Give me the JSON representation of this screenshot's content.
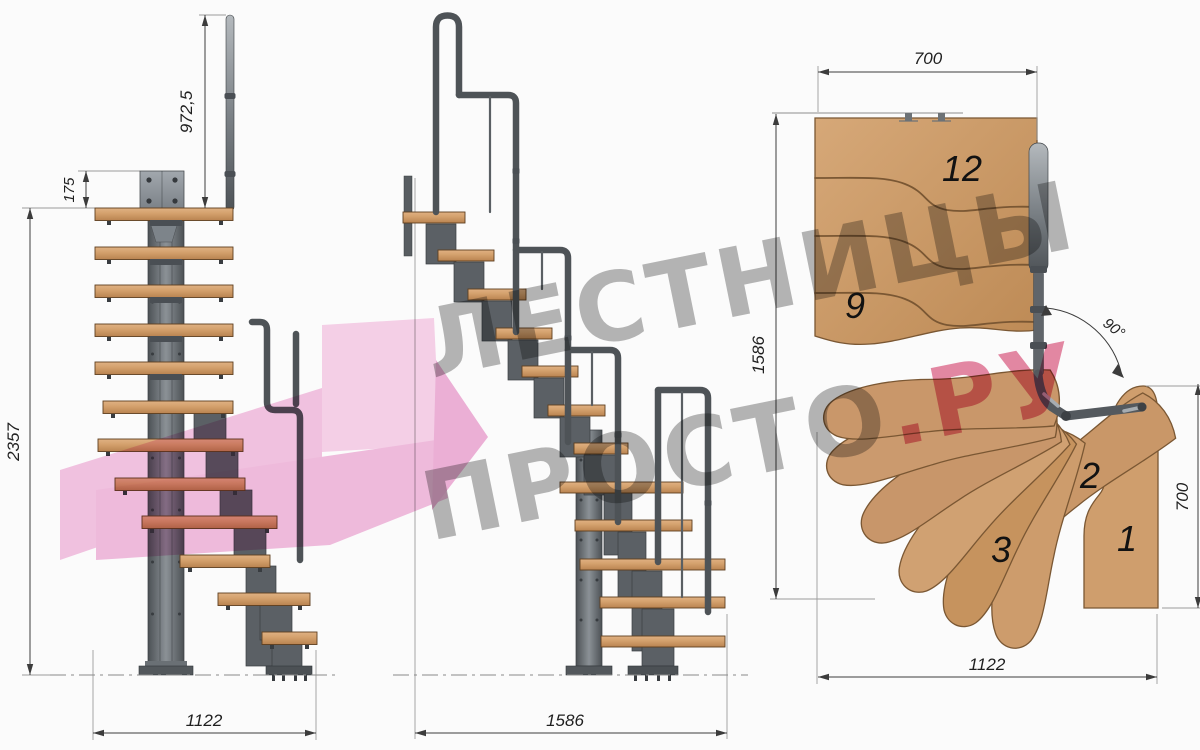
{
  "watermark": {
    "line1": "ЛЕСТНИЦЫ",
    "line2_gray": "ПРОСТО",
    "line2_accent": ".РУ",
    "gray_color": "#6e6e6e",
    "accent_color": "#d84a74",
    "arrow_color": "#f3bade"
  },
  "front_view": {
    "dimensions": {
      "handrail_height": "972,5",
      "top_platform_depth": "175",
      "total_height": "2357",
      "footprint_width": "1122"
    }
  },
  "side_view": {
    "dimensions": {
      "footprint_length": "1586"
    }
  },
  "plan_view": {
    "dimensions": {
      "top_width": "700",
      "length": "1586",
      "right_width": "700",
      "bottom_width": "1122",
      "turn_angle": "90°"
    },
    "step_numbers": {
      "s12": "12",
      "s9": "9",
      "s3": "3",
      "s2": "2",
      "s1": "1"
    }
  },
  "colors": {
    "wood": "#cb9a6a",
    "metal": "#5b6065",
    "dimension_lines": "#3c3c3c",
    "background": "#fbfbfb"
  }
}
